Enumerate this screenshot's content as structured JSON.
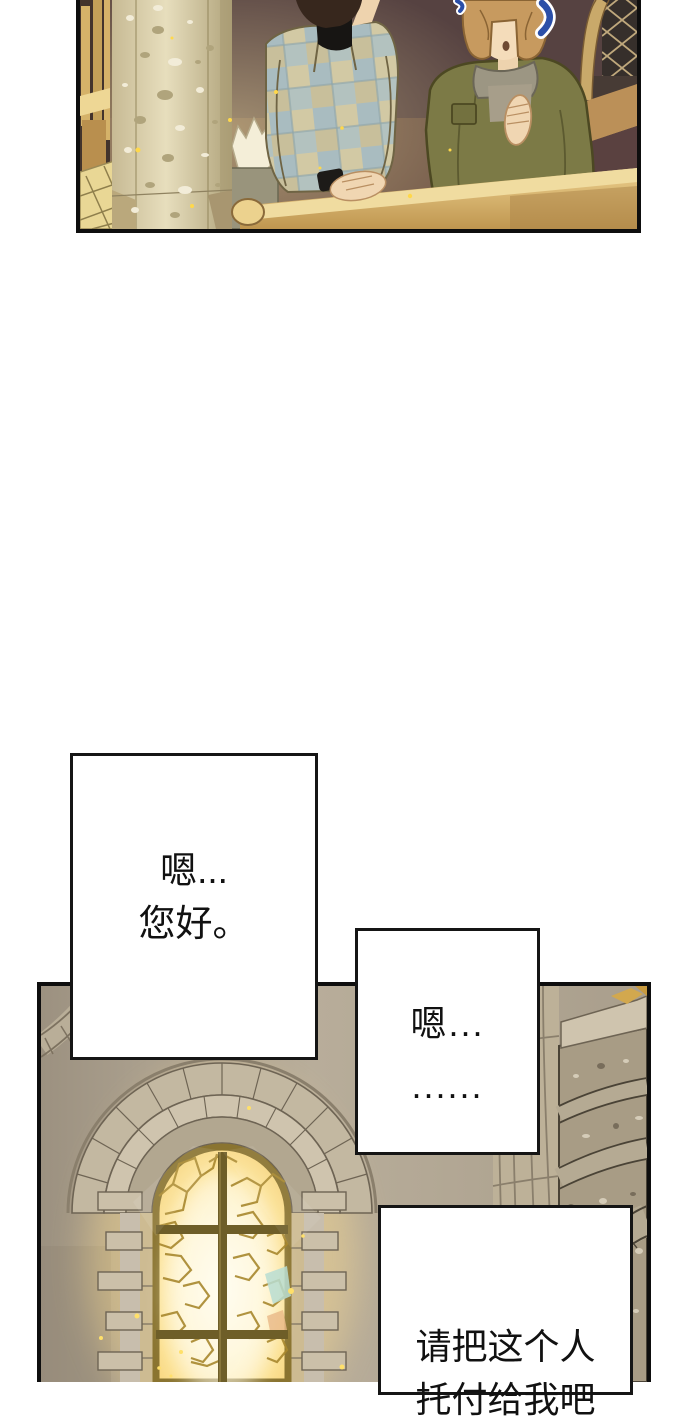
{
  "page": {
    "kind": "webtoon-comic-strip",
    "background": "#ffffff"
  },
  "colors": {
    "page_bg": "#ffffff",
    "panel_border": "#0e0e0e",
    "bubble_border": "#151515",
    "bubble_bg": "#ffffff",
    "text_color": "#111111",
    "pew_gold": "#e3c077",
    "pillar_stone": "#ded3b0",
    "plaid_jacket": "#c8bf9b",
    "green_jacket": "#7c7a46",
    "wall_taupe": "#b0a592",
    "window_glow": "#ffe9a8",
    "leading_gold": "#a8882e",
    "surprise_mark_blue": "#2b4fa8"
  },
  "panels": [
    {
      "alt": "Two people kneeling in prayer at golden wooden church pews beside a speckled stone pillar"
    },
    {
      "alt": "Tall arched stained-glass window glowing gold in a taupe stone church wall"
    }
  ],
  "bubbles": [
    {
      "lines": [
        "嗯...",
        "您好。"
      ]
    },
    {
      "lines": [
        "嗯...",
        "......"
      ]
    },
    {
      "lines": [
        "请把这个人",
        "托付给我吧"
      ]
    }
  ]
}
